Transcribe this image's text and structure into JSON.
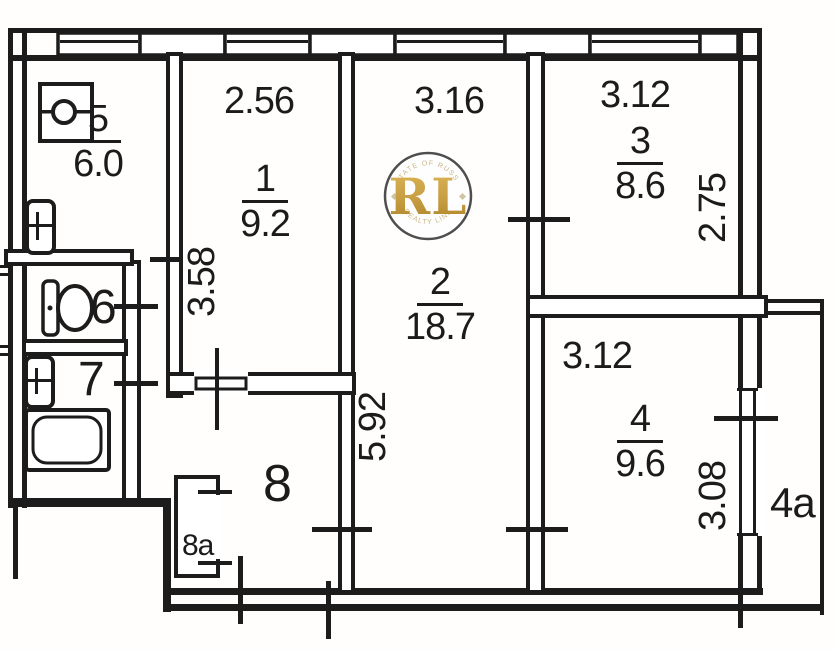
{
  "plan": {
    "line_color": "#1c1c1c",
    "background": "#ffffff",
    "rooms": {
      "kitchen": {
        "number": "5",
        "area": "6.0"
      },
      "room1": {
        "number": "1",
        "area": "9.2",
        "width": "2.56",
        "depth": "3.58"
      },
      "room2": {
        "number": "2",
        "area": "18.7",
        "width": "3.16",
        "depth": "5.92"
      },
      "room3": {
        "number": "3",
        "area": "8.6",
        "width": "3.12",
        "depth": "2.75"
      },
      "room4": {
        "number": "4",
        "area": "9.6",
        "width": "3.12",
        "depth": "3.08"
      },
      "wc": {
        "number": "6"
      },
      "bathroom": {
        "number": "7"
      },
      "hallway": {
        "number": "8"
      },
      "closet": {
        "number": "8a"
      },
      "balcony": {
        "number": "4a"
      }
    },
    "watermark": {
      "letters": "RL",
      "arc_top": "ESTATE OF RUSSIA",
      "arc_bottom": "REALTY LINK",
      "gold_color": "#c49a3b"
    }
  }
}
